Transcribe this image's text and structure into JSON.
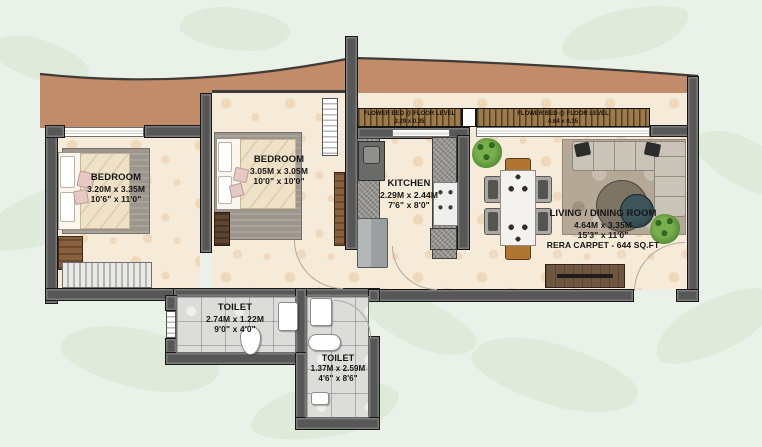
{
  "plan": {
    "type": "residential-floor-plan",
    "rooms": {
      "bedroom1": {
        "name": "BEDROOM",
        "dim_m": "3.20M x 3.35M",
        "dim_ft": "10'6\" x 11'0\""
      },
      "bedroom2": {
        "name": "BEDROOM",
        "dim_m": "3.05M x 3.05M",
        "dim_ft": "10'0\" x 10'0\""
      },
      "kitchen": {
        "name": "KITCHEN",
        "dim_m": "2.29M x 2.44M",
        "dim_ft": "7'6\" x 8'0\""
      },
      "living": {
        "name": "LIVING / DINING ROOM",
        "dim_m": "4.64M x 3.35M",
        "dim_ft": "15'3\" x 11'0\"",
        "rera": "RERA CARPET - 644 SQ.FT"
      },
      "toilet1": {
        "name": "TOILET",
        "dim_m": "2.74M x 1.22M",
        "dim_ft": "9'0\" x 4'0\""
      },
      "toilet2": {
        "name": "TOILET",
        "dim_m": "1.37M x 2.59M",
        "dim_ft": "4'6\" x 8'6\""
      }
    },
    "flower_beds": {
      "left": {
        "label": "FLOWER BED @ FLOOR LEVEL",
        "dim": "2.29 x 0.35"
      },
      "right": {
        "label": "FLOWER BED @ FLOOR LEVEL",
        "dim": "4.64 x 0.35"
      }
    },
    "colors": {
      "background": "#eaf1e8",
      "leaf_watermark": "#dfeada",
      "terrace_tan": "#c28b69",
      "wall_gray": "#575757",
      "floor_cream": "#f6ead8",
      "tile_gray": "#dcdcda",
      "flower_bed_wood": "#9c7a4c",
      "plant_green": "#4e8a33",
      "label_text": "#161616"
    }
  }
}
